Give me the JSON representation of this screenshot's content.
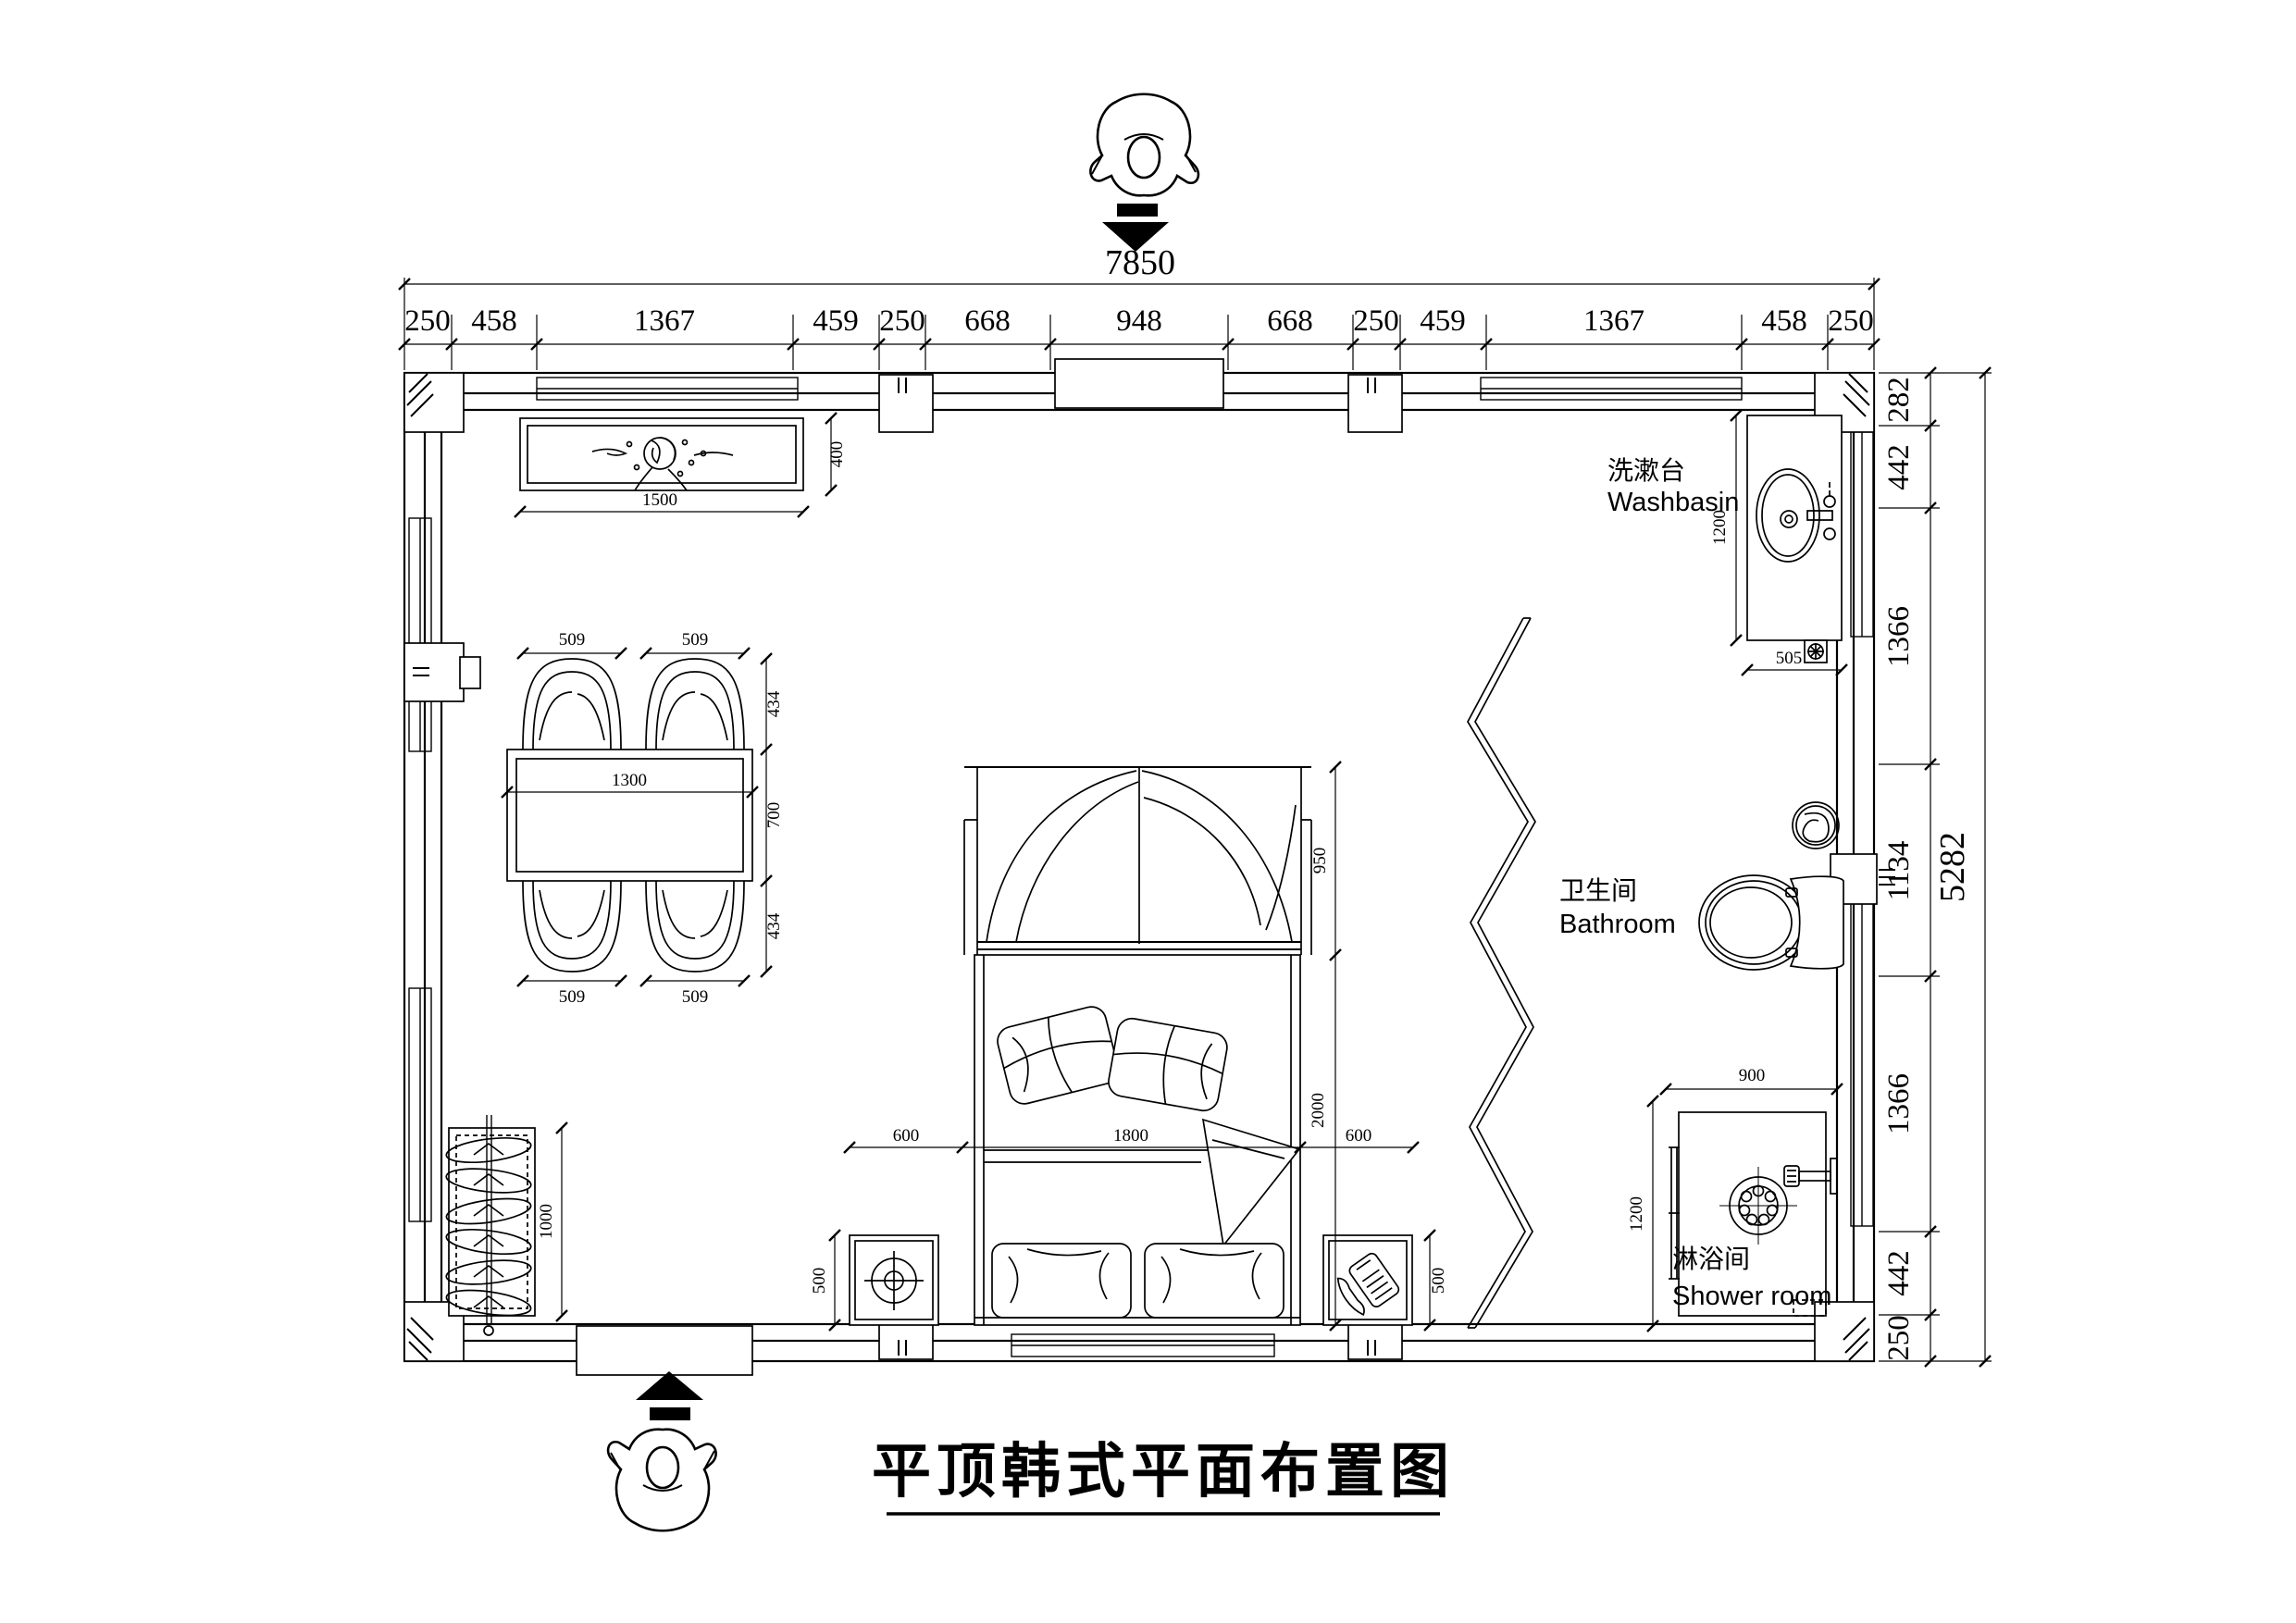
{
  "title": {
    "text": "平顶韩式平面布置图"
  },
  "rooms": {
    "washbasin": {
      "zh": "洗漱台",
      "en": "Washbasin"
    },
    "bathroom": {
      "zh": "卫生间",
      "en": "Bathroom"
    },
    "shower": {
      "zh": "淋浴间",
      "en": "Shower room"
    }
  },
  "dims": {
    "top_total": "7850",
    "top": [
      "250",
      "458",
      "1367",
      "459",
      "250",
      "668",
      "948",
      "668",
      "250",
      "459",
      "1367",
      "458",
      "250"
    ],
    "right_total": "5282",
    "right": [
      "282",
      "442",
      "1366",
      "1134",
      "1366",
      "442",
      "250"
    ],
    "cabinet_w": "1500",
    "cabinet_d": "400",
    "table_w": "1300",
    "chair_tl": "509",
    "chair_tr": "509",
    "chair_bl": "509",
    "chair_br": "509",
    "chair_depth_top": "434",
    "table_depth": "700",
    "chair_depth_bottom": "434",
    "wardrobe_h": "1000",
    "bed_left": "600",
    "bed_w": "1800",
    "bed_right": "600",
    "bed_len": "2000",
    "canopy": "950",
    "ns_left": "500",
    "ns_right": "500",
    "basin_len": "1200",
    "basin_w": "505",
    "shower_w": "900",
    "shower_d": "1200"
  }
}
